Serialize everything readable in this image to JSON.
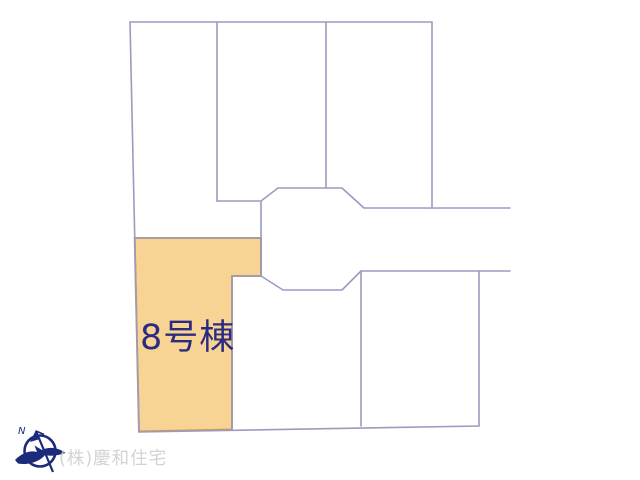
{
  "canvas": {
    "width": 640,
    "height": 480,
    "background": "#ffffff"
  },
  "site_plan": {
    "type": "residential-lot-layout",
    "line_color": "#9b9bc0",
    "highlighted_lot": {
      "label": "8号棟",
      "fill_color": "#f8d494",
      "border_color": "#cf9a4e",
      "label_color": "#2b2b80",
      "label_font_size": 35
    }
  },
  "compass": {
    "label": "N",
    "color": "#1b2a7a"
  },
  "watermark": {
    "text": "(株)慶和住宅",
    "color": "#d3d3d3"
  }
}
